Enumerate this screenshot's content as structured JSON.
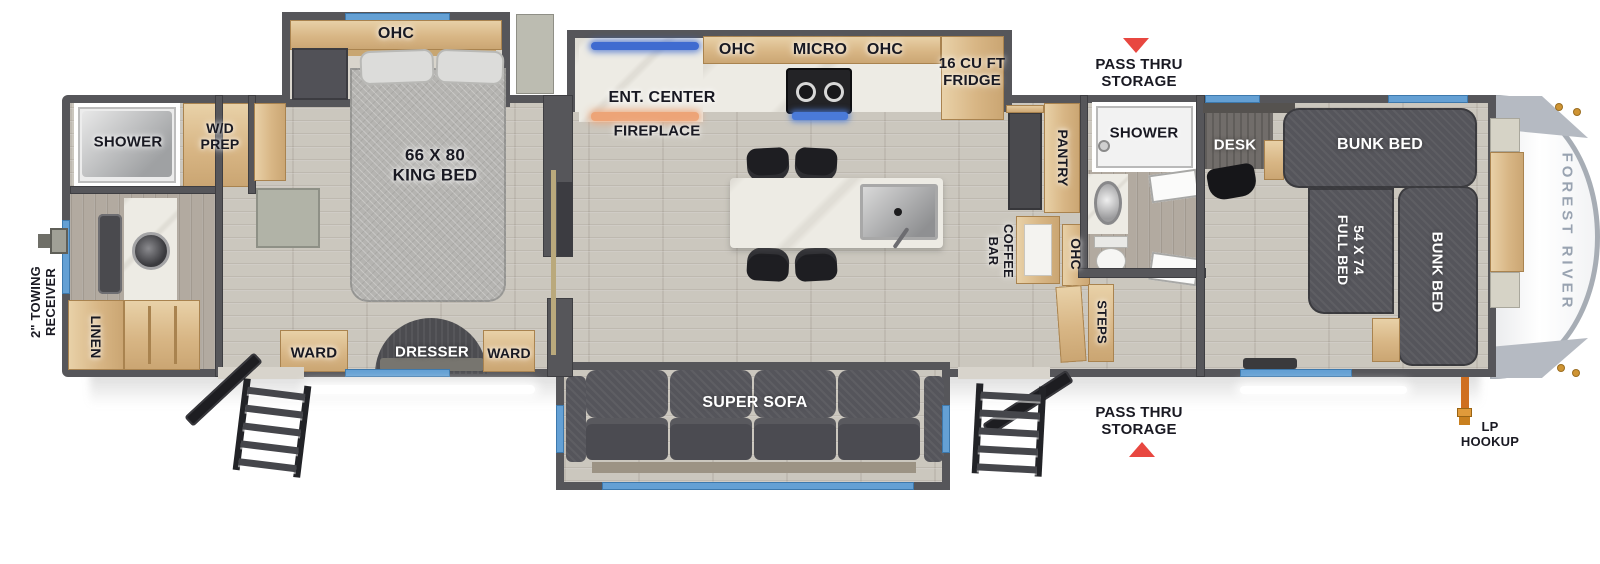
{
  "title": "Forest River fifth wheel RV floor plan",
  "colors": {
    "wall": "#56565a",
    "floor": "#cbc7be",
    "wood_cabinet": "#d8b685",
    "dark_furniture": "#515157",
    "king_bed_gray": "#b5b4b1",
    "window_blue": "#64a0d4",
    "arrow_red": "#e84740",
    "led_blue": "#3f6bd0",
    "fireplace_orange": "#eda477",
    "label_dark": "#191922",
    "label_light": "#ffffff",
    "brand_gray": "#99a3b1",
    "lp_hose_orange": "#cf6f20"
  },
  "exterior": {
    "towing_line1": "2\" TOWING",
    "towing_line2": "RECEIVER",
    "pass_thru_top_line1": "PASS THRU",
    "pass_thru_top_line2": "STORAGE",
    "pass_thru_bottom_line1": "PASS THRU",
    "pass_thru_bottom_line2": "STORAGE",
    "lp_line1": "LP",
    "lp_line2": "HOOKUP",
    "brand": "FOREST RIVER"
  },
  "rear_bath": {
    "shower": "SHOWER",
    "wd_prep_line1": "W/D",
    "wd_prep_line2": "PREP",
    "linen": "LINEN"
  },
  "bedroom": {
    "ohc": "OHC",
    "king_bed_line1": "66 X 80",
    "king_bed_line2": "KING BED",
    "ward_left": "WARD",
    "dresser": "DRESSER",
    "ward_right": "WARD"
  },
  "kitchen": {
    "ent_center": "ENT. CENTER",
    "fireplace": "FIREPLACE",
    "ohc_left": "OHC",
    "micro": "MICRO",
    "ohc_right": "OHC",
    "fridge_line1": "16 CU FT",
    "fridge_line2": "FRIDGE",
    "pantry": "PANTRY",
    "coffee_bar_line1": "COFFEE",
    "coffee_bar_line2": "BAR",
    "ohc_coffee": "OHC"
  },
  "living": {
    "super_sofa": "SUPER SOFA"
  },
  "mid_bath": {
    "shower": "SHOWER",
    "steps": "STEPS"
  },
  "bunk_room": {
    "desk": "DESK",
    "bunk_top": "BUNK BED",
    "full_bed_line1": "54 X 74",
    "full_bed_line2": "FULL BED",
    "bunk_right": "BUNK BED"
  }
}
